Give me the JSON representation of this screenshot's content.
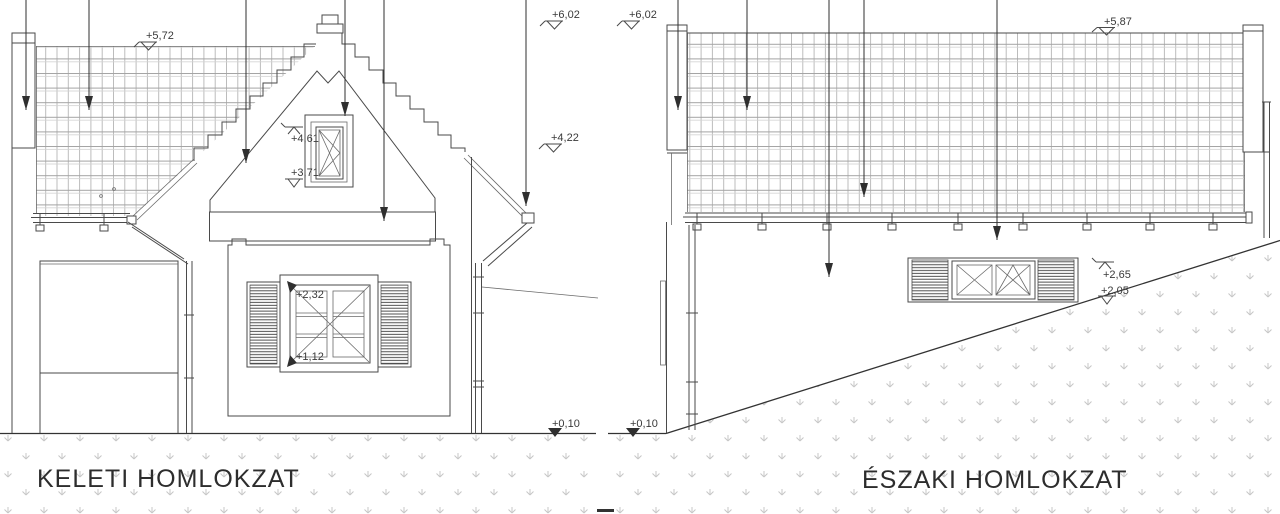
{
  "sheet": {
    "type_note": "architectural elevation drawing, two facades",
    "left_elevation": {
      "title": "KELETI HOMLOKZAT",
      "markers": {
        "roof_back": "+5,72",
        "ridge": "+6,02",
        "eave": "+4,22",
        "gable_window_top": "+4,61",
        "gable_window_bottom": "+3,71",
        "window_top": "+2,32",
        "window_bottom": "+1,12",
        "ground": "+0,10"
      }
    },
    "right_elevation": {
      "title": "ÉSZAKI HOMLOKZAT",
      "markers": {
        "ridge_left": "+6,02",
        "ridge_right": "+5,87",
        "window_top": "+2,65",
        "window_bottom": "+2,05",
        "ground": "+0,10"
      }
    }
  }
}
